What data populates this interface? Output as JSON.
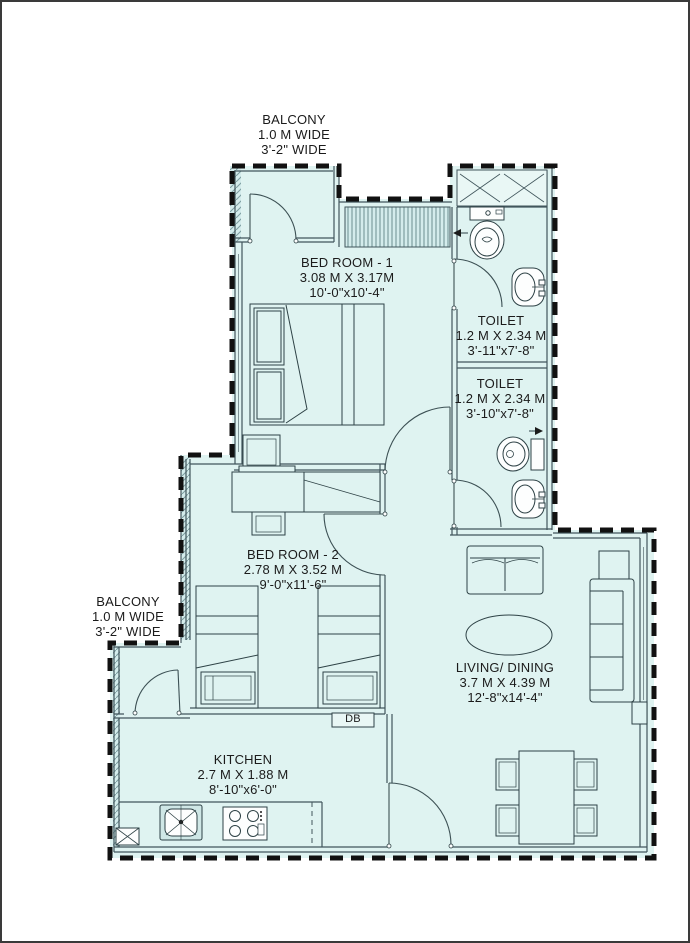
{
  "rooms": {
    "balcony_top": {
      "name": "BALCONY",
      "width_metric": "1.0 M WIDE",
      "width_imperial": "3'-2\" WIDE"
    },
    "bedroom1": {
      "name": "BED ROOM - 1",
      "size_metric": "3.08 M X 3.17M",
      "size_imperial": "10'-0\"x10'-4\""
    },
    "toilet1": {
      "name": "TOILET",
      "size_metric": "1.2 M X 2.34 M",
      "size_imperial": "3'-11\"x7'-8\""
    },
    "toilet2": {
      "name": "TOILET",
      "size_metric": "1.2 M X 2.34 M",
      "size_imperial": "3'-10\"x7'-8\""
    },
    "bedroom2": {
      "name": "BED ROOM - 2",
      "size_metric": "2.78 M X 3.52 M",
      "size_imperial": "9'-0\"x11'-6\""
    },
    "balcony_left": {
      "name": "BALCONY",
      "width_metric": "1.0 M WIDE",
      "width_imperial": "3'-2\" WIDE"
    },
    "living_dining": {
      "name": "LIVING/ DINING",
      "size_metric": "3.7 M X 4.39 M",
      "size_imperial": "12'-8\"x14'-4\""
    },
    "kitchen": {
      "name": "KITCHEN",
      "size_metric": "2.7 M X 1.88 M",
      "size_imperial": "8'-10\"x6'-0\""
    },
    "distribution_board": {
      "label": "DB"
    }
  },
  "colors": {
    "floor_fill": "#dff3f1",
    "wall_line": "#41565c",
    "boundary": "#111111",
    "text": "#1b1b1b"
  }
}
